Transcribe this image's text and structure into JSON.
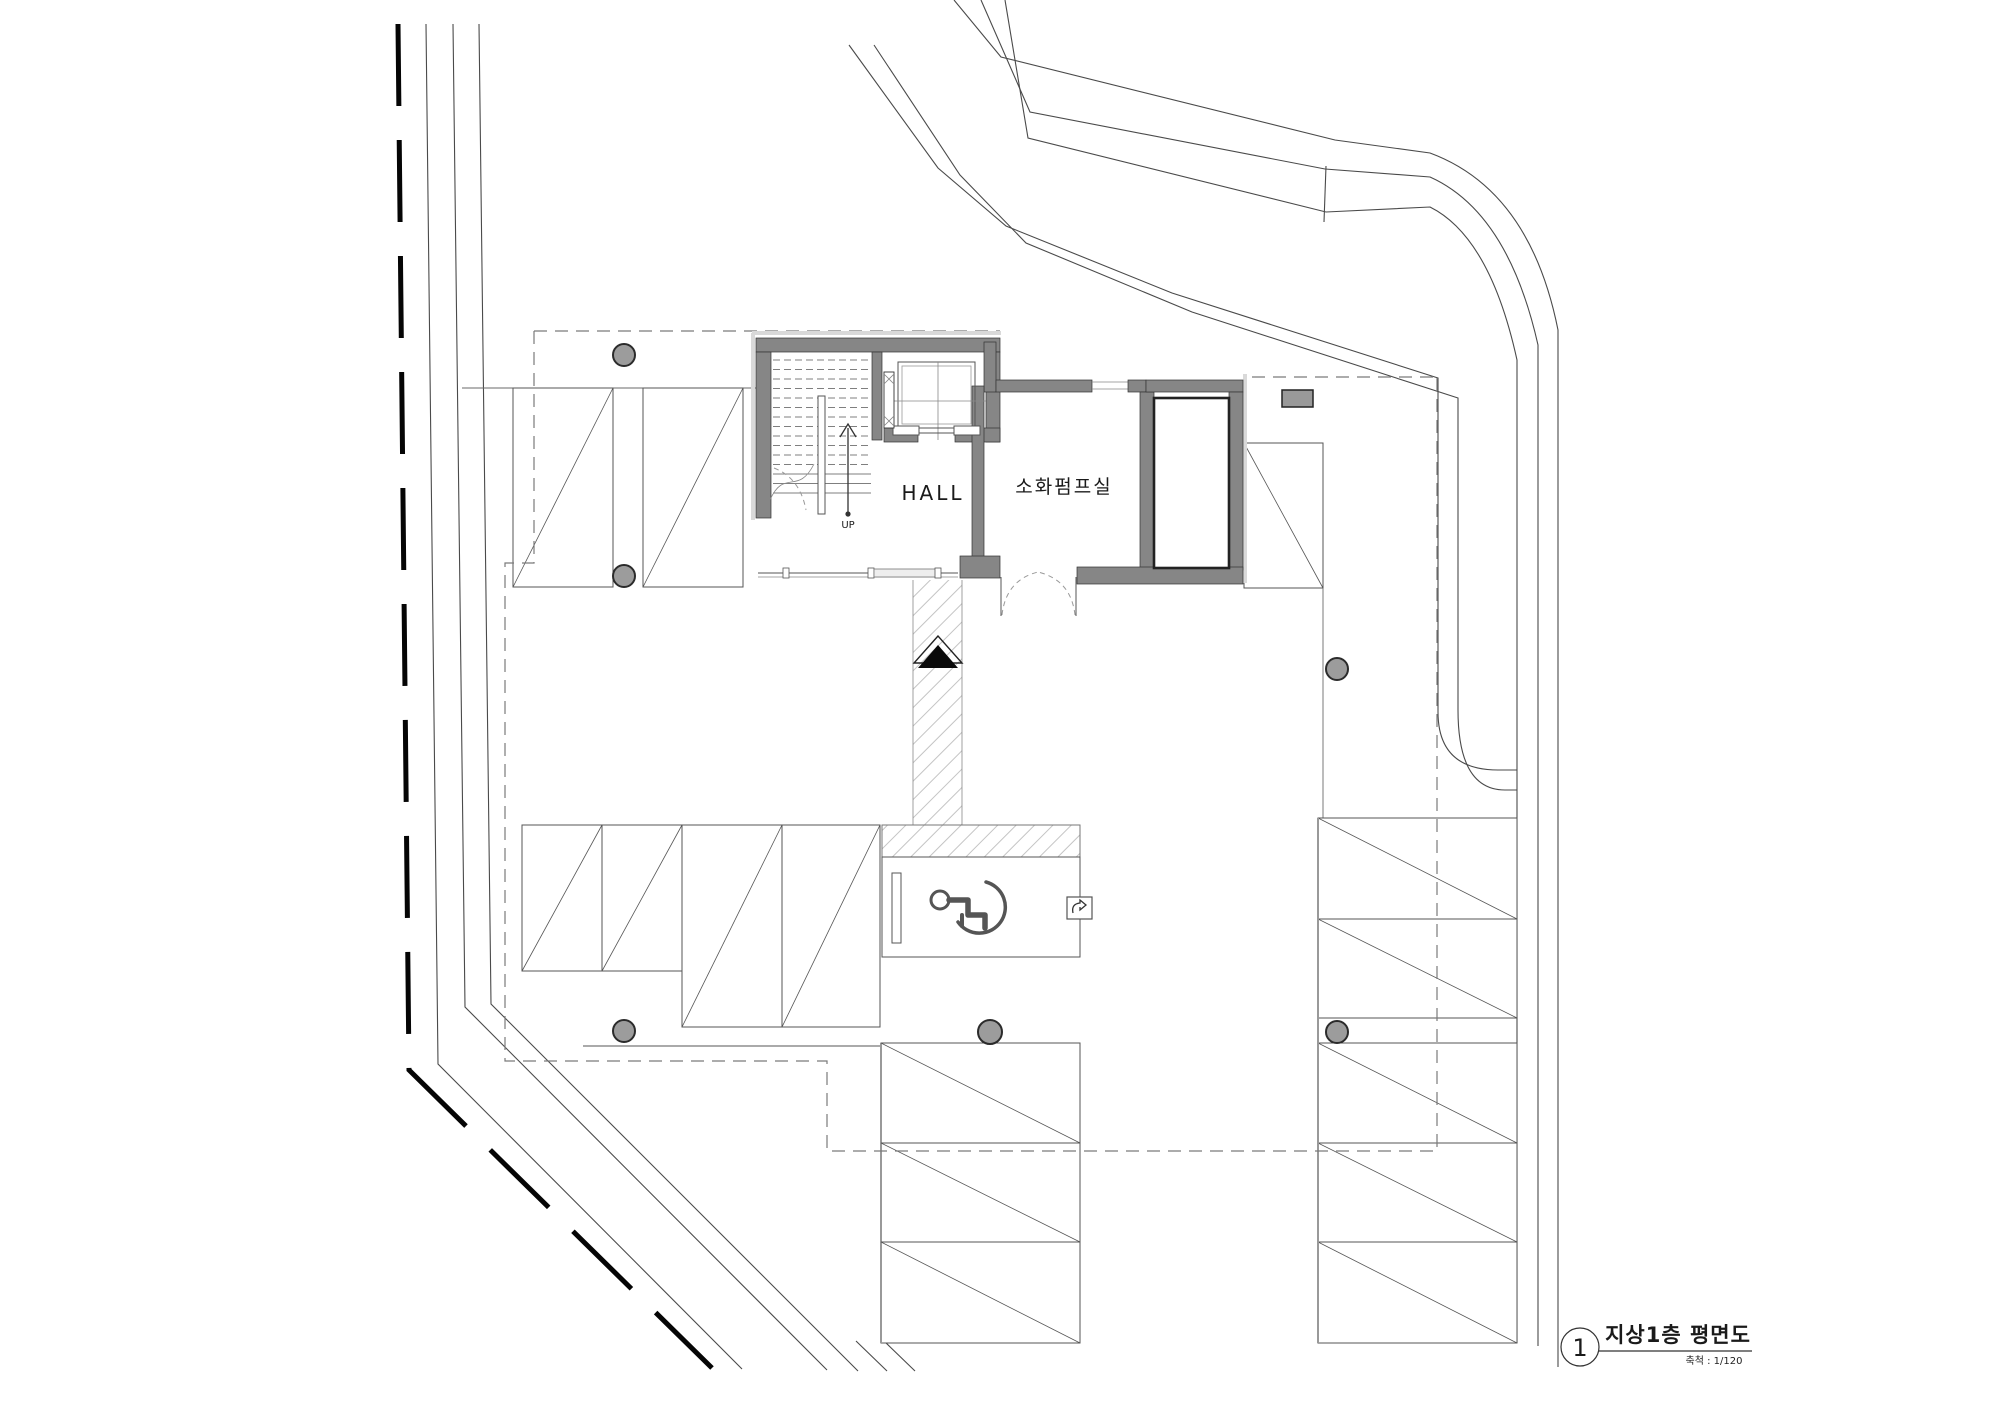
{
  "drawing": {
    "labels": {
      "hall": "HALL",
      "pump_room": "소화펌프실",
      "up": "UP"
    },
    "title_block": {
      "index": "1",
      "title": "지상1층 평면도",
      "scale": "축척 : 1/120"
    },
    "colors": {
      "wall_gray": "#868686",
      "bollard_gray": "#9c9c9c",
      "boundary_black": "#050505",
      "line_dark": "#4a4a4a",
      "paper_white": "#ffffff"
    }
  }
}
